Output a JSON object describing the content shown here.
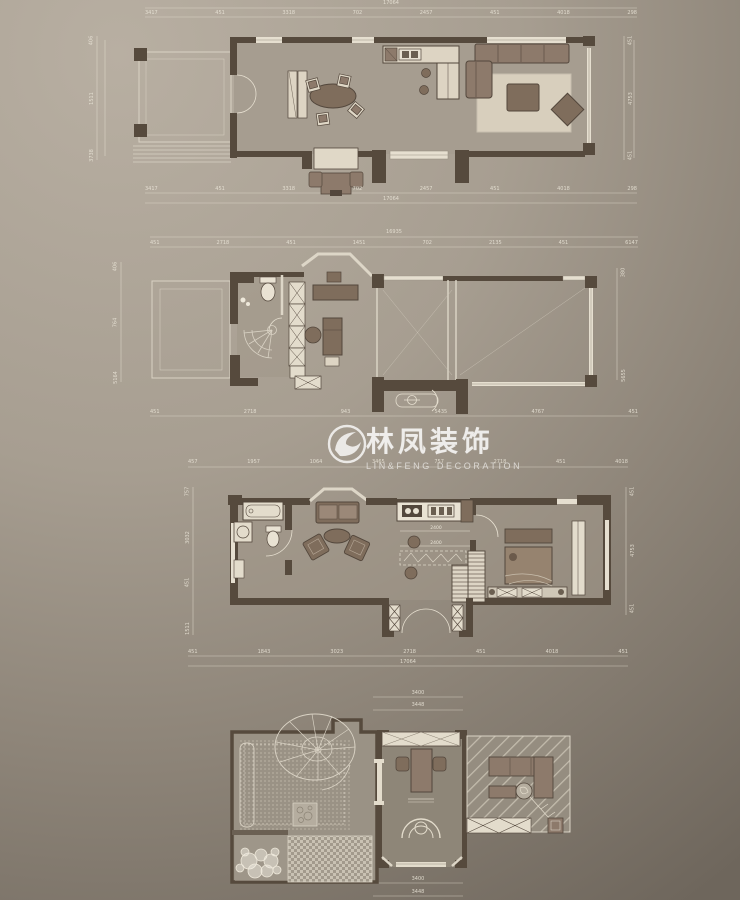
{
  "watermark": {
    "brand_cn": "林凤装饰",
    "brand_en": "LIN&FENG DECORATION",
    "logo_icon": "phoenix-swoosh-logo"
  },
  "palette": {
    "background_top_left": "#b8afa2",
    "background_bottom_right": "#6e665c",
    "wall_color": "#564a3d",
    "furniture_dark": "#7f6d5c",
    "furniture_light": "#ddd4c3",
    "drawing_line_light": "#e3dccd",
    "watermark_color": "rgba(255,255,255,0.75)"
  },
  "plans": {
    "floor1": {
      "dims_top_total": "17064",
      "dims_top": [
        "3417",
        "451",
        "3318",
        "702",
        "2457",
        "451",
        "4018",
        "298"
      ],
      "dims_bottom": [
        "3417",
        "451",
        "3318",
        "702",
        "2457",
        "451",
        "4018",
        "298"
      ],
      "dims_bottom_total": "17064",
      "dims_left": [
        "406",
        "1511",
        "3738"
      ],
      "dims_right": [
        "451",
        "4753",
        "451"
      ]
    },
    "floor2": {
      "dims_top_total": "16935",
      "dims_top": [
        "451",
        "2718",
        "451",
        "1451",
        "702",
        "2135",
        "451",
        "6147"
      ],
      "dims_bottom": [
        "451",
        "2718",
        "943",
        "5435",
        "4767",
        "451"
      ],
      "dims_left": [
        "406",
        "764",
        "5164"
      ],
      "dims_right": [
        "380",
        "5655"
      ]
    },
    "floor3": {
      "dims_top": [
        "457",
        "1957",
        "1064",
        "3465",
        "757",
        "2718",
        "451",
        "4018"
      ],
      "dims_bottom": [
        "451",
        "1843",
        "3023",
        "2718",
        "451",
        "4018",
        "451"
      ],
      "dims_bottom_total": "17064",
      "dims_left": [
        "757",
        "3032",
        "451",
        "1511"
      ],
      "dims_right": [
        "451",
        "4753",
        "451"
      ],
      "annotations": [
        "2400",
        "2400"
      ]
    },
    "floor4": {
      "dims_top": [
        "3400",
        "3448"
      ],
      "dims_bottom": [
        "3400",
        "3448"
      ]
    }
  }
}
